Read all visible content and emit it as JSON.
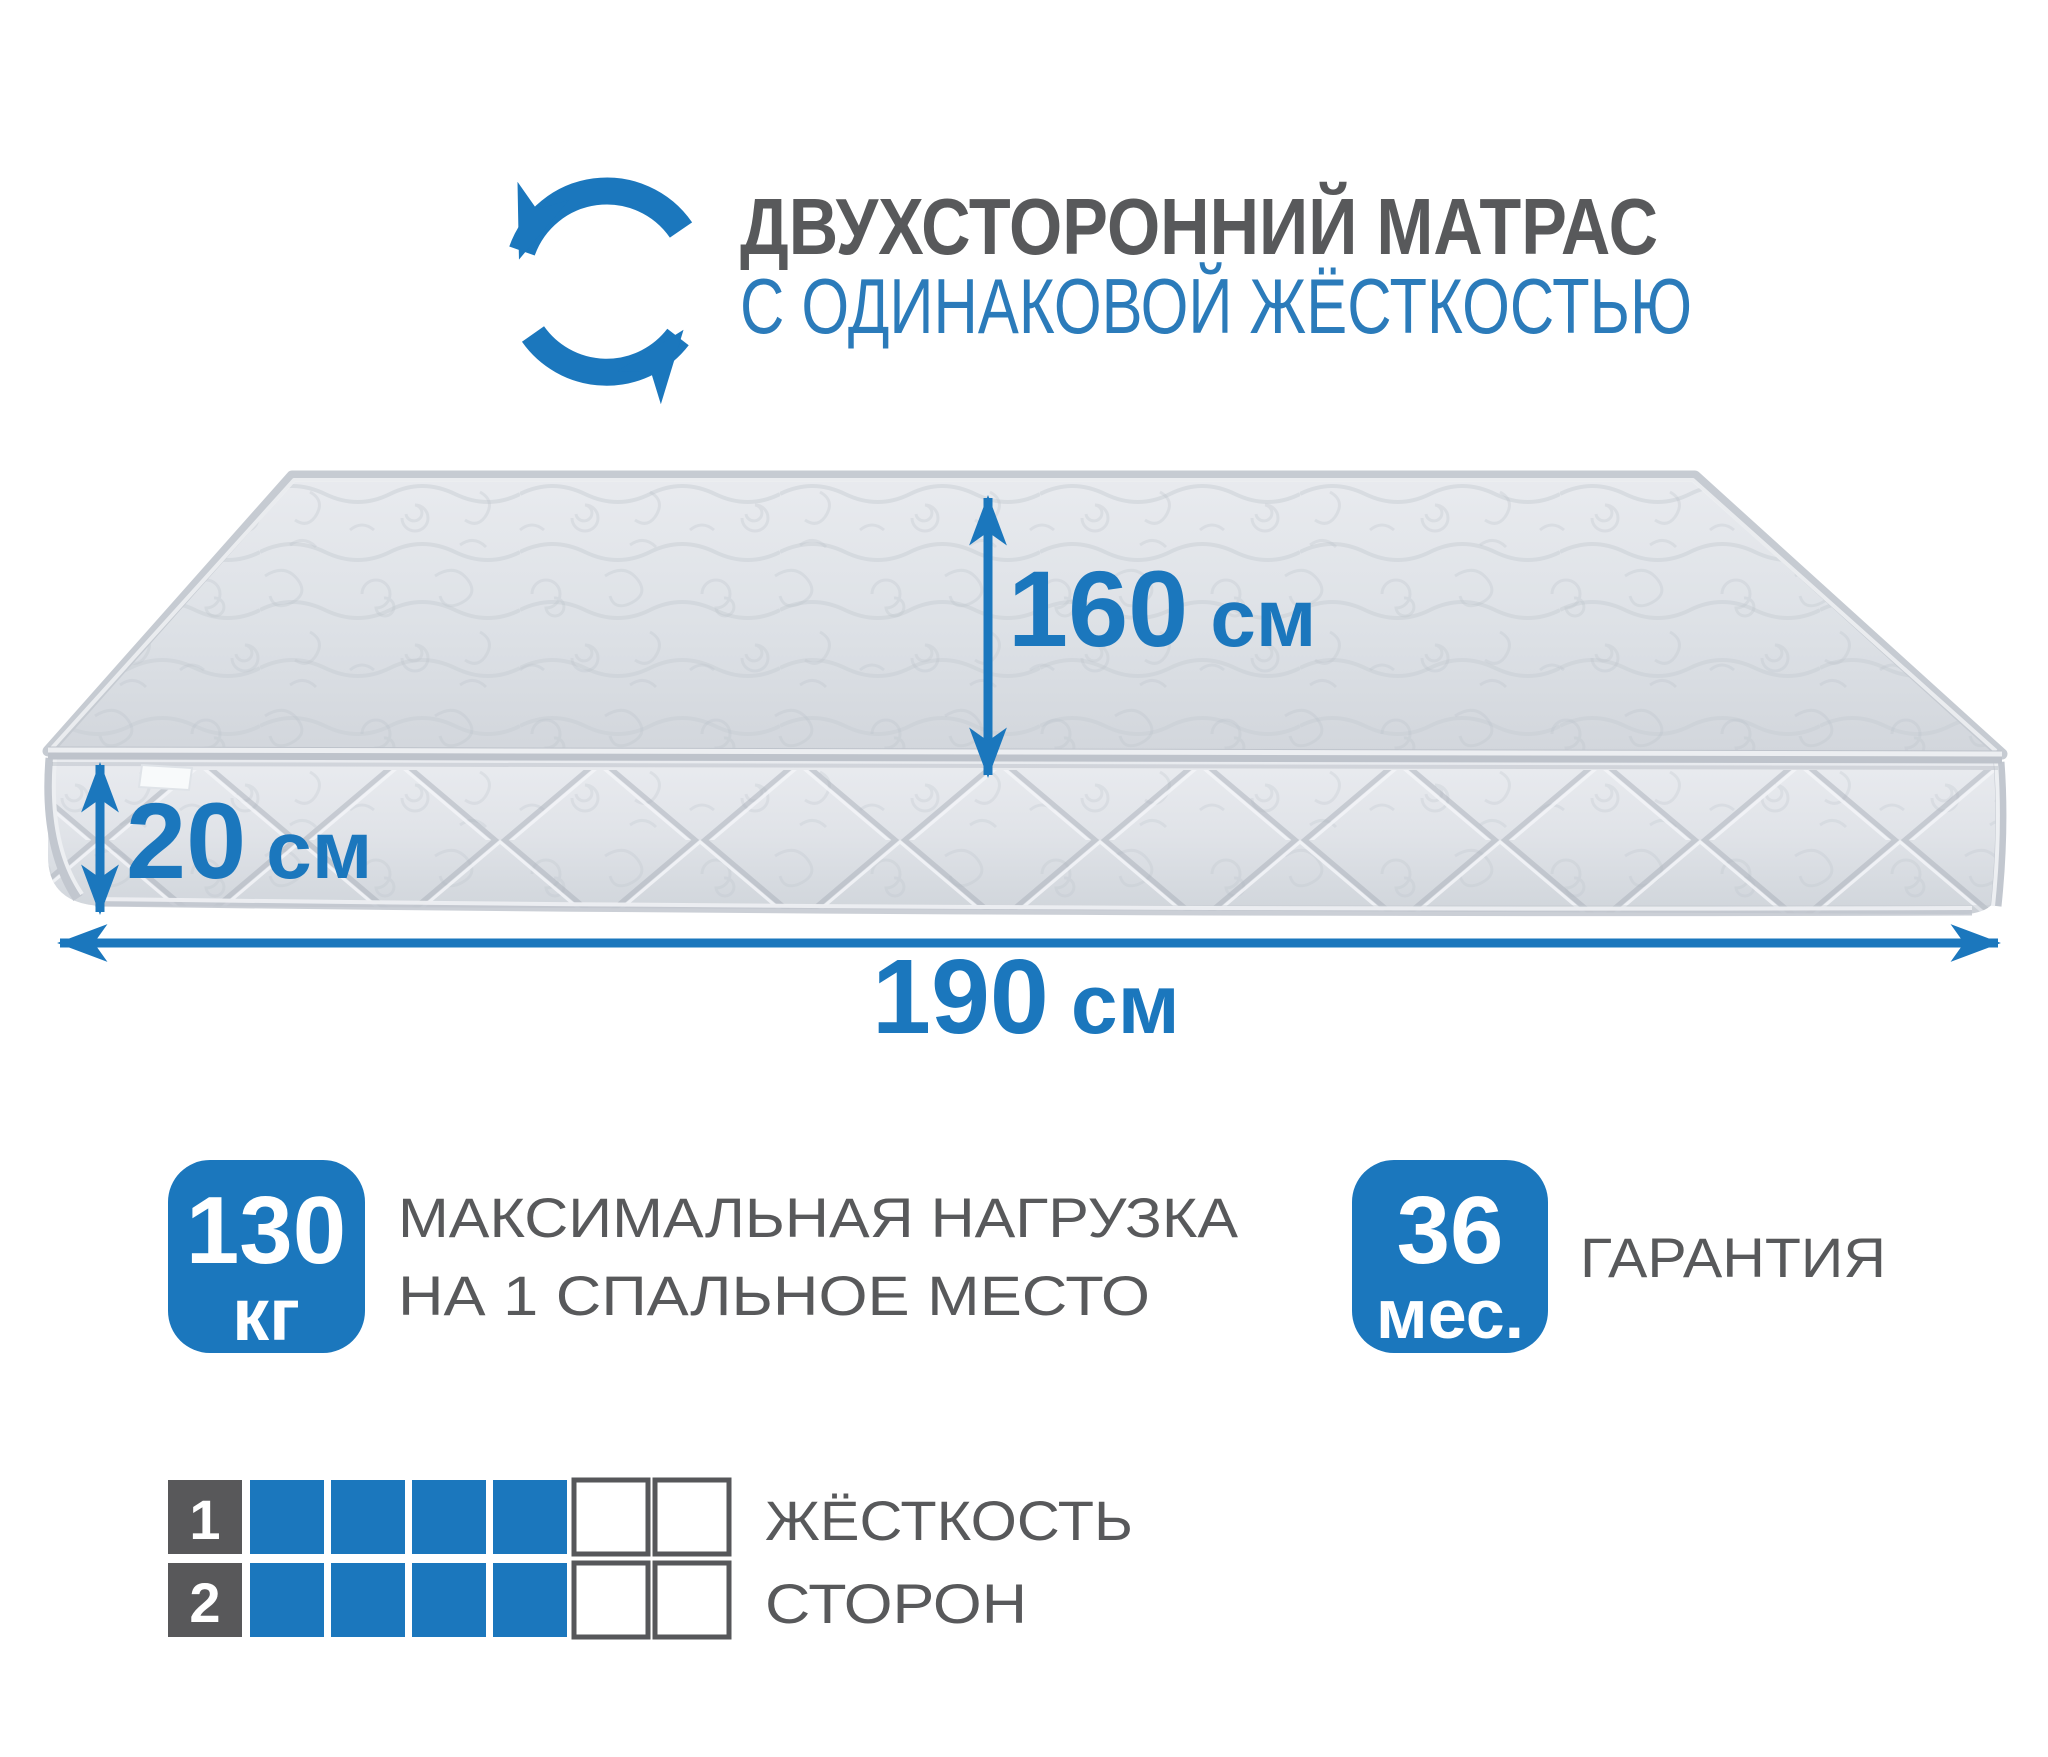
{
  "header": {
    "icon": "rotate-arrows-icon",
    "title_line1": "ДВУХСТОРОННИЙ МАТРАС",
    "title_line2": "С ОДИНАКОВОЙ ЖЁСТКОСТЬЮ"
  },
  "mattress": {
    "dimensions": {
      "depth": {
        "value": "160",
        "unit": "см"
      },
      "height": {
        "value": "20",
        "unit": "см"
      },
      "length": {
        "value": "190",
        "unit": "см"
      }
    }
  },
  "features": {
    "max_load": {
      "value": "130",
      "unit": "кг",
      "label_line1": "МАКСИМАЛЬНАЯ НАГРУЗКА",
      "label_line2": "НА 1 СПАЛЬНОЕ МЕСТО"
    },
    "warranty": {
      "value": "36",
      "unit": "мес.",
      "label": "ГАРАНТИЯ"
    }
  },
  "hardness": {
    "label_line1": "ЖЁСТКОСТЬ",
    "label_line2": "СТОРОН",
    "scale_max": 6,
    "rows": [
      {
        "index": "1",
        "filled": 4
      },
      {
        "index": "2",
        "filled": 4
      }
    ]
  },
  "colors": {
    "accent_blue": "#1B77BD",
    "title_blue": "#2B7BBA",
    "text_gray": "#58595B",
    "box_gray": "#58585A",
    "mattress_light": "#E8EAEE",
    "mattress_mid": "#D6DAE0",
    "mattress_dark": "#C6CBD2"
  }
}
